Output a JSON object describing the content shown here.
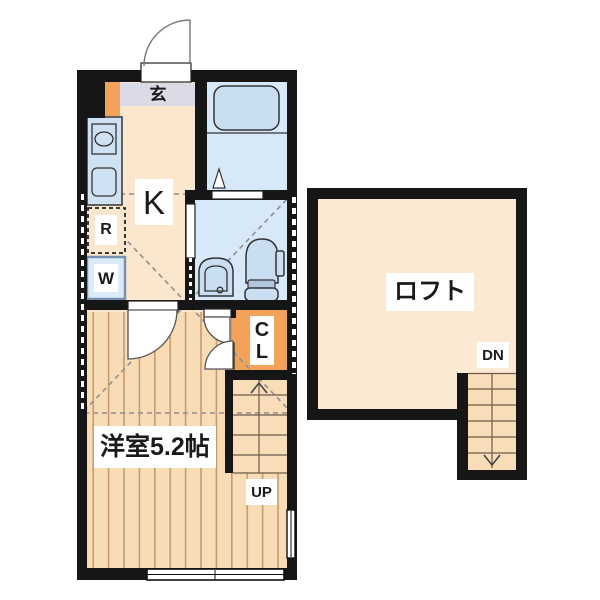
{
  "plan": {
    "unit": {
      "genkan_label": "玄",
      "kitchen_label": "K",
      "refrigerator_label": "R",
      "washer_label": "W",
      "closet_line1": "C",
      "closet_line2": "L",
      "room_label": "洋室5.2帖",
      "stairs_up_label": "UP"
    },
    "loft": {
      "name_label": "ロフト",
      "stairs_down_label": "DN"
    }
  },
  "colors": {
    "wall": "#161616",
    "cream": "#fbe7cd",
    "loftcream": "#fce9d3",
    "wood": "#f8dcb5",
    "woodstripe": "#c69b72",
    "stairfill": "#f9ddb8",
    "stairline": "#6b5b48",
    "bathbg": "#d7e8f8",
    "fixture": "#cadef2",
    "stroke": "#333333",
    "counter": "#cfe2f4",
    "orange": "#f2a359",
    "genkanstrip": "#dadbe6",
    "dash": "#8f8f8f"
  }
}
